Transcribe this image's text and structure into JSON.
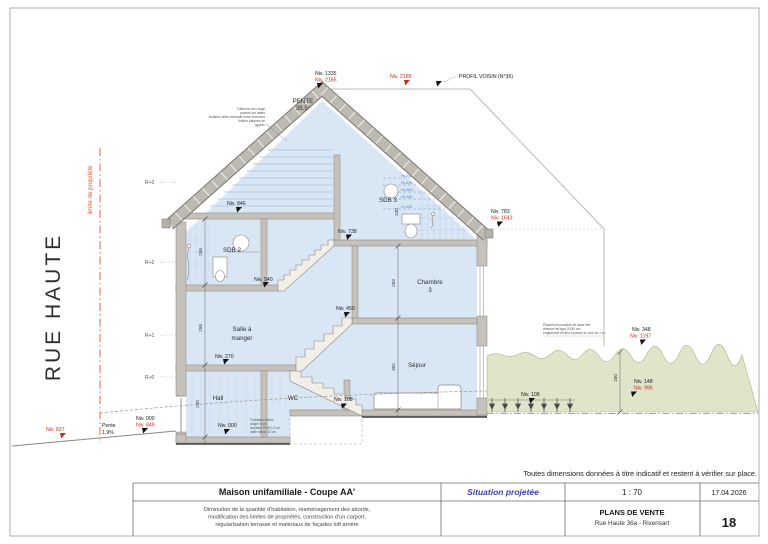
{
  "sheet": {
    "street": "RUE HAUTE",
    "property_line": "limite de propriété",
    "note": "Toutes dimensions données à titre indicatif et restent à vérifier sur place.",
    "level_axis": [
      "R+3",
      "R+2",
      "R+1",
      "R+0"
    ]
  },
  "drawing": {
    "roof_pitch": {
      "label": "PENTE",
      "value": "39,5°"
    },
    "neighbor_profile": "PROFIL VOISIN (N°36)",
    "street_slope": {
      "label": "Pente",
      "value": "1,9%"
    },
    "rooms": {
      "sdb2": "SDB 2",
      "sdb3": "SDB 3",
      "chambre_l1": "Chambre",
      "chambre_l2": "3",
      "salle_l1": "Salle à",
      "salle_l2": "manger",
      "sejour": "Séjour",
      "hall": "Hall",
      "wc": "WC"
    },
    "levels": {
      "ridge": {
        "black": "Niv. 1335",
        "red": "Niv. 2185"
      },
      "neighbor_ridge": {
        "red": "Niv. 2185"
      },
      "eaves_right": {
        "black": "Niv. 783",
        "red": "Niv. 1643"
      },
      "attic_left": {
        "black": "Niv. 846"
      },
      "attic_right": {
        "black": "Niv. 738"
      },
      "sdb2_floor": {
        "black": "Niv. 540"
      },
      "palier": {
        "black": "Niv. 450"
      },
      "salle": {
        "black": "Niv. 270"
      },
      "sejour": {
        "black": "Niv. 108"
      },
      "terrace": {
        "black": "Niv. 108"
      },
      "terrain_top": {
        "black": "Niv. 348",
        "red": "Niv. 1197"
      },
      "terrain_low": {
        "black": "Niv. 148",
        "red": "Niv. 996"
      },
      "street_far": {
        "red": "Niv. 827"
      },
      "entrance": {
        "black": "Niv. 000",
        "red": "Niv. 849"
      },
      "hall": {
        "black": "Niv. 000"
      }
    },
    "headroom_lines": [
      "H=240",
      "H=220",
      "H=200",
      "H=190",
      "H=150"
    ],
    "dimensions": {
      "sdb2_height": "258",
      "salle_height": "258",
      "hall_height": "240",
      "chambre_height": "253",
      "sejour_height": "302",
      "sdb3_height": "240",
      "terrain_depth": "200"
    },
    "annotations": {
      "roof_buildup": [
        "Tuiles de ton rouge",
        "posées sur lattes",
        "isolation laine minérale entre chevrons",
        "finition plaques de",
        "gyproc"
      ],
      "talus": [
        "Placement possible de talus vert",
        "retenue de type 20/30 cm",
        "engazonné en lieu et place du mur de 1 m"
      ],
      "foundation": [
        "Fondation béton",
        "chape 8 cm",
        "isolation PUR 12 cm",
        "dalle béton 22 cm"
      ]
    }
  },
  "titleblock": {
    "title": "Maison unifamiliale - Coupe AA'",
    "situation": "Situation projetée",
    "scale": "1 : 70",
    "date": "17.04.2026",
    "description": [
      "Diminution de la quantité d'habitation, réaménagement des abords,",
      "modification des limites de propriétés, construction d'un carport,",
      "régularisation terrasse et matériaux de façades loft arrière"
    ],
    "plans": "PLANS DE VENTE",
    "address": "Rue Haute 36a - Rixensart",
    "page_number": "18"
  },
  "colors": {
    "marker_red": "#c5301f",
    "property_orange": "#e05a28",
    "accent_blue": "#3c3cc0",
    "interior_blue": "#d9e7f5",
    "terrain_green": "#e0e4c8",
    "structure_gray": "#c6c2bb"
  }
}
